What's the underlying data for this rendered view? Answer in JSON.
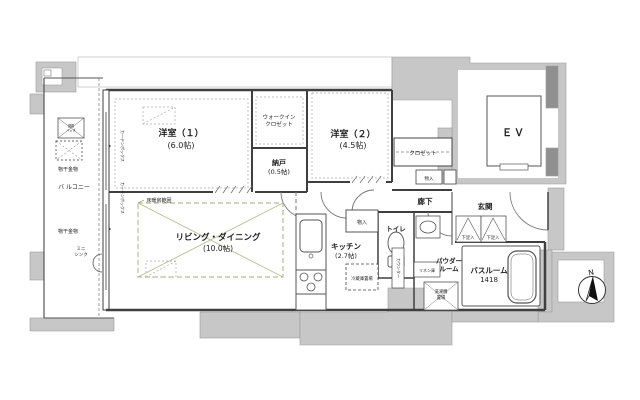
{
  "plan": {
    "colors": {
      "wall_gray": "#c7c7c7",
      "line_dark": "#3f3f3f",
      "heating_green_text": "#7d9144",
      "heating_green_line": "#b9bd92"
    },
    "rooms": {
      "bedroom1": {
        "name": "洋室（１）",
        "size": "(6.0帖)"
      },
      "wic": {
        "line1": "ウォークイン",
        "line2": "クロゼット"
      },
      "nando": {
        "name": "納戸",
        "size": "(0.5帖)"
      },
      "bedroom2": {
        "name": "洋室（２）",
        "size": "(4.5帖)"
      },
      "closet": {
        "name": "クロゼット"
      },
      "closet_monoire": {
        "name": "物入"
      },
      "living": {
        "name": "リビング・ダイニング",
        "size": "(10.0帖)"
      },
      "kitchen": {
        "name": "キッチン",
        "size": "(2.7帖)"
      },
      "toilet": {
        "name": "トイレ"
      },
      "hall_monoire": {
        "name": "物入"
      },
      "corridor": {
        "name": "廊下"
      },
      "entrance": {
        "name": "玄関"
      },
      "shoe_box": {
        "name": "下足入"
      },
      "powder": {
        "line1": "パウダー",
        "line2": "ルーム"
      },
      "bath": {
        "name": "バスルーム",
        "size": "1418"
      },
      "ev": {
        "name": "ＥＶ"
      },
      "balcony": {
        "name": "バ ルコニー"
      }
    },
    "annotations": {
      "floor_heating": "床暖房範囲",
      "fridge": "冷蔵庫置場",
      "counter": "カウンター",
      "linen": "リネン庫",
      "washer_line1": "洗濯機",
      "washer_line2": "置場",
      "monohoshi": "物干金物",
      "mini_sink_line1": "ミニ",
      "mini_sink_line2": "シンク",
      "hatch_line1": "避難",
      "hatch_line2": "ハッチ",
      "curtain_box": "カーテンボックス",
      "compass_n": "N"
    }
  }
}
